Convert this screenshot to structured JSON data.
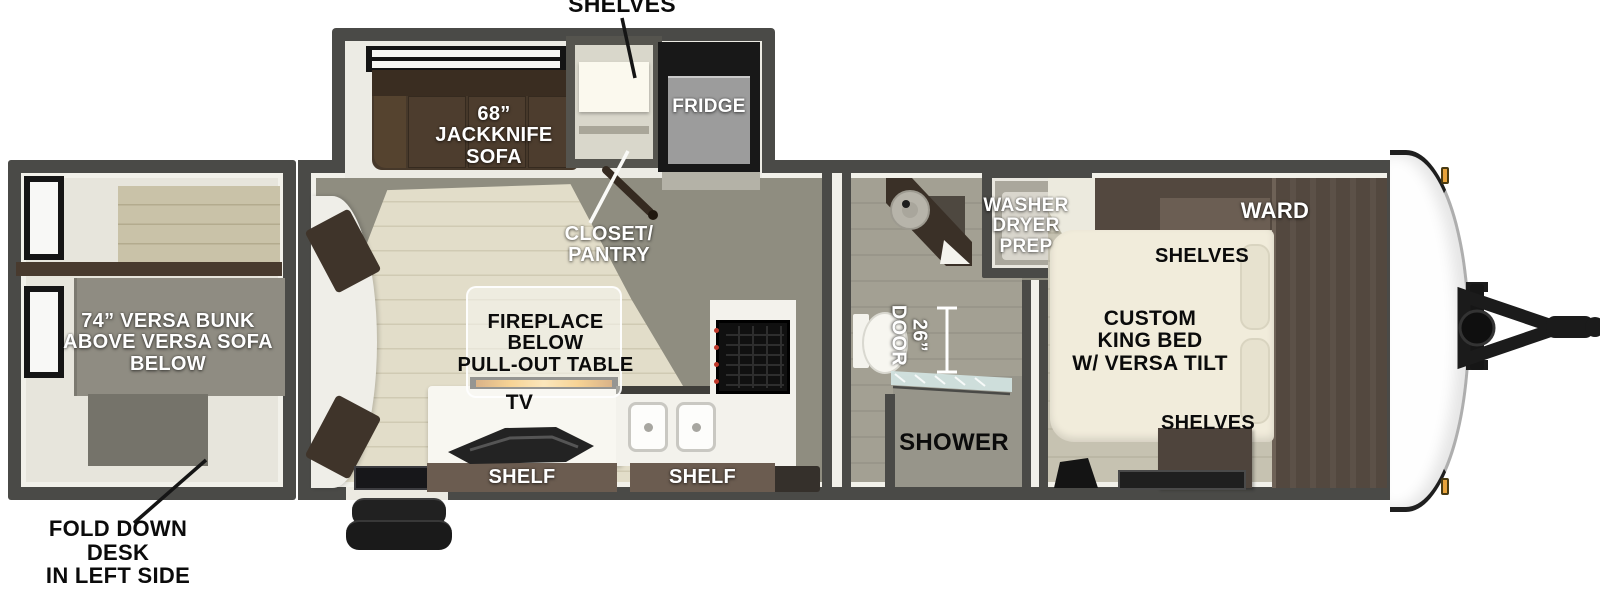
{
  "callouts": {
    "shelves_top": "SHELVES",
    "fold_down_desk": "FOLD DOWN DESK\nIN LEFT SIDE\nREAR BED"
  },
  "rear_bedroom": {
    "bunk": "74” VERSA BUNK\nABOVE VERSA SOFA\nBELOW"
  },
  "living_kitchen": {
    "sofa": "68”\nJACKKNIFE\nSOFA",
    "closet": "CLOSET/\nPANTRY",
    "fridge": "FRIDGE",
    "fireplace_table": "FIREPLACE\nBELOW\nPULL-OUT TABLE",
    "tv": "TV",
    "shelf_left": "SHELF",
    "shelf_right": "SHELF"
  },
  "bathroom": {
    "door_width": "26”\nDOOR",
    "shower": "SHOWER",
    "washer_dryer_prep": "WASHER\nDRYER\nPREP"
  },
  "front_bedroom": {
    "wardrobe": "WARD",
    "shelves_upper": "SHELVES",
    "bed": "CUSTOM\nKING BED\nW/ VERSA TILT",
    "shelves_lower": "SHELVES"
  },
  "colors": {
    "wall": "#4a4a47",
    "floor_gray": "#8f8d80",
    "floor_planks": "#e2ddc9",
    "sofa_brown": "#46382a",
    "cabinet_brown": "#53483f",
    "shelf_bar_brown": "#6b5c50",
    "bed_cream": "#f1ecdb",
    "fireplace_glow": "#f0971c",
    "marker_light": "#e8a33c",
    "fridge_gray": "#9c9c9c"
  }
}
